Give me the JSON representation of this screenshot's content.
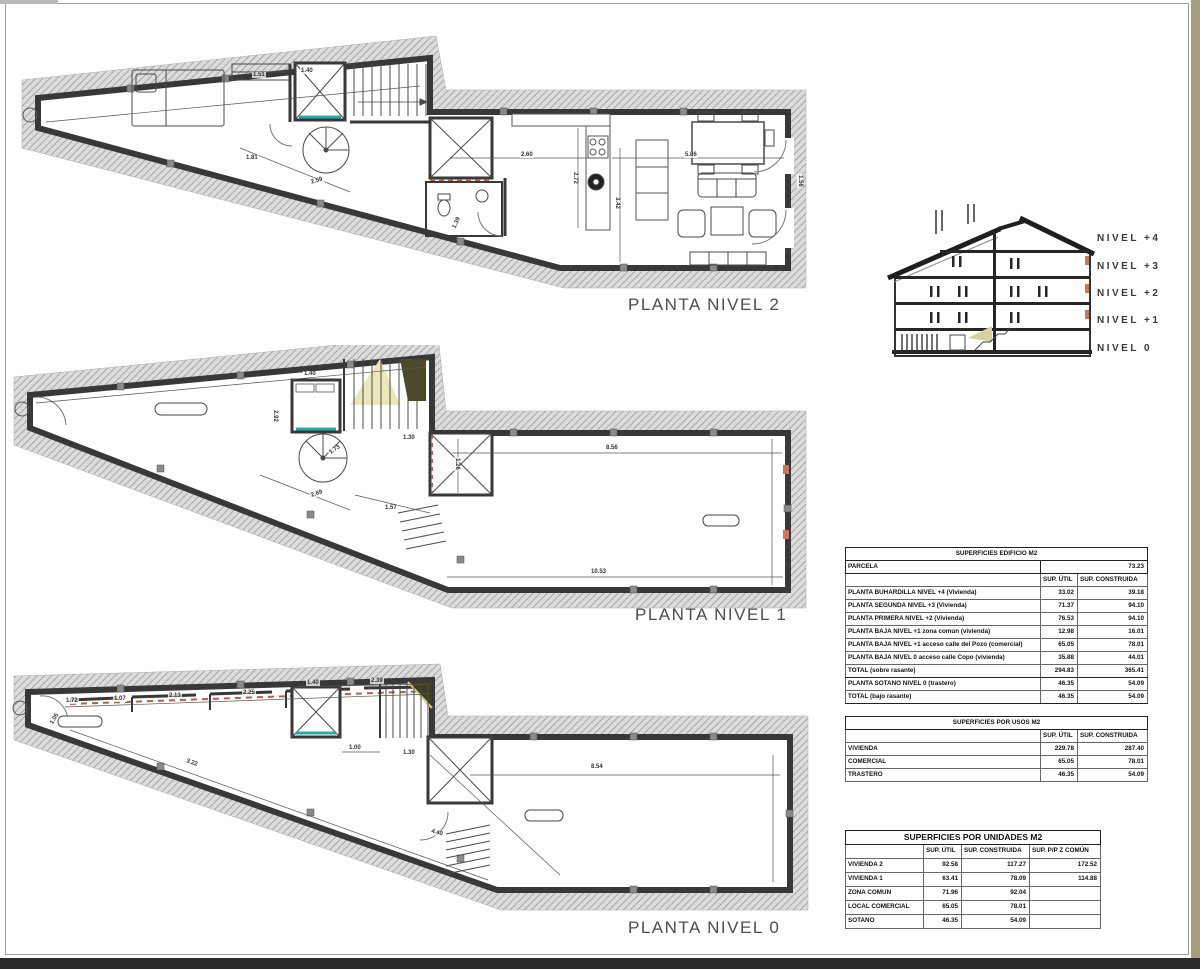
{
  "plans": [
    {
      "label": "PLANTA NIVEL 2",
      "dims": [
        {
          "x": 280,
          "y": 38,
          "t": "1.40"
        },
        {
          "x": 232,
          "y": 42,
          "t": "1.51"
        },
        {
          "x": 500,
          "y": 122,
          "t": "2.60"
        },
        {
          "x": 664,
          "y": 122,
          "t": "5.86"
        },
        {
          "x": 548,
          "y": 145,
          "t": "2.72",
          "r": 90
        },
        {
          "x": 590,
          "y": 170,
          "t": "3.42",
          "r": 90
        },
        {
          "x": 225,
          "y": 125,
          "t": "1.81"
        },
        {
          "x": 290,
          "y": 148,
          "t": "2.59",
          "r": -17
        },
        {
          "x": 430,
          "y": 190,
          "t": "1.39",
          "r": -65
        },
        {
          "x": 773,
          "y": 148,
          "t": "1.56",
          "r": 90
        }
      ]
    },
    {
      "label": "PLANTA NIVEL 1",
      "dims": [
        {
          "x": 293,
          "y": 26,
          "t": "1.40"
        },
        {
          "x": 258,
          "y": 68,
          "t": "2.92",
          "r": 90
        },
        {
          "x": 300,
          "y": 146,
          "t": "2.69",
          "r": -19
        },
        {
          "x": 374,
          "y": 160,
          "t": "1.57"
        },
        {
          "x": 595,
          "y": 100,
          "t": "8.56"
        },
        {
          "x": 580,
          "y": 224,
          "t": "10.53"
        },
        {
          "x": 440,
          "y": 116,
          "t": "1.26",
          "r": 90
        },
        {
          "x": 318,
          "y": 102,
          "t": "1.73",
          "r": -35
        },
        {
          "x": 392,
          "y": 90,
          "t": "1.30"
        }
      ]
    },
    {
      "label": "PLANTA NIVEL 0",
      "dims": [
        {
          "x": 55,
          "y": 38,
          "t": "1.72"
        },
        {
          "x": 103,
          "y": 36,
          "t": "1.07"
        },
        {
          "x": 158,
          "y": 33,
          "t": "2.13"
        },
        {
          "x": 232,
          "y": 30,
          "t": "2.25"
        },
        {
          "x": 296,
          "y": 20,
          "t": "1.40"
        },
        {
          "x": 360,
          "y": 18,
          "t": "2.39"
        },
        {
          "x": 338,
          "y": 85,
          "t": "1.00"
        },
        {
          "x": 392,
          "y": 90,
          "t": "1.30"
        },
        {
          "x": 580,
          "y": 104,
          "t": "8.54"
        },
        {
          "x": 175,
          "y": 100,
          "t": "3.22",
          "r": 18
        },
        {
          "x": 420,
          "y": 170,
          "t": "4.40",
          "r": 16
        },
        {
          "x": 38,
          "y": 56,
          "t": "1.05",
          "r": -60
        }
      ]
    }
  ],
  "section": {
    "levels": [
      "NIVEL +4",
      "NIVEL +3",
      "NIVEL +2",
      "NIVEL +1",
      "NIVEL 0"
    ]
  },
  "tables": {
    "edificio": {
      "title": "SUPERFICIES EDIFICIO M2",
      "parcela_label": "PARCELA",
      "parcela_value": "73.23",
      "col_headers": [
        "SUP. ÚTIL",
        "SUP. CONSTRUIDA"
      ],
      "rows": [
        {
          "label": "PLANTA BUHARDILLA NIVEL +4 (Vivienda)",
          "util": "33.02",
          "construida": "39.18"
        },
        {
          "label": "PLANTA SEGUNDA NIVEL +3 (Vivienda)",
          "util": "71.37",
          "construida": "94.10"
        },
        {
          "label": "PLANTA PRIMERA NIVEL +2 (Vivienda)",
          "util": "76.53",
          "construida": "94.10"
        },
        {
          "label": "PLANTA BAJA NIVEL +1 zona común (vivienda)",
          "util": "12.98",
          "construida": "16.01"
        },
        {
          "label": "PLANTA BAJA NIVEL +1 acceso calle del Pozo (comercial)",
          "util": "65.05",
          "construida": "78.01"
        },
        {
          "label": "PLANTA BAJA NIVEL 0 acceso calle Copo (vivienda)",
          "util": "35.88",
          "construida": "44.01"
        }
      ],
      "total_sobre": {
        "label": "TOTAL (sobre rasante)",
        "util": "294.83",
        "construida": "365.41"
      },
      "sotano": {
        "label": "PLANTA SOTANO NIVEL 0 (trastero)",
        "util": "46.35",
        "construida": "54.09"
      },
      "total_bajo": {
        "label": "TOTAL (bajo rasante)",
        "util": "46.35",
        "construida": "54.09"
      }
    },
    "usos": {
      "title": "SUPERFICIES POR USOS M2",
      "col_headers": [
        "SUP. ÚTIL",
        "SUP. CONSTRUIDA"
      ],
      "rows": [
        {
          "label": "VIVIENDA",
          "util": "229.78",
          "construida": "287.40"
        },
        {
          "label": "COMERCIAL",
          "util": "65.05",
          "construida": "78.01"
        },
        {
          "label": "TRASTERO",
          "util": "46.35",
          "construida": "54.09"
        }
      ]
    },
    "unidades": {
      "title": "SUPERFICIES POR UNIDADES M2",
      "col_headers": [
        "SUP. ÚTIL",
        "SUP. CONSTRUIDA",
        "SUP. P/P Z COMÚN"
      ],
      "rows": [
        {
          "label": "VIVIENDA 2",
          "util": "92.58",
          "construida": "117.27",
          "pp": "172.52"
        },
        {
          "label": "VIVIENDA 1",
          "util": "63.41",
          "construida": "78.09",
          "pp": "114.88"
        },
        {
          "label": "ZONA COMUN",
          "util": "71.96",
          "construida": "92.04",
          "pp": ""
        },
        {
          "label": "LOCAL COMERCIAL",
          "util": "65.05",
          "construida": "78.01",
          "pp": ""
        },
        {
          "label": "SOTANO",
          "util": "46.35",
          "construida": "54.09",
          "pp": ""
        }
      ]
    }
  },
  "colors": {
    "wall": "#383838",
    "teal_accent": "#2ba8a2",
    "orange_accent": "#b3604a",
    "page_edge_band": "#a69d7e",
    "bottom_bar": "#2b2b2b"
  }
}
